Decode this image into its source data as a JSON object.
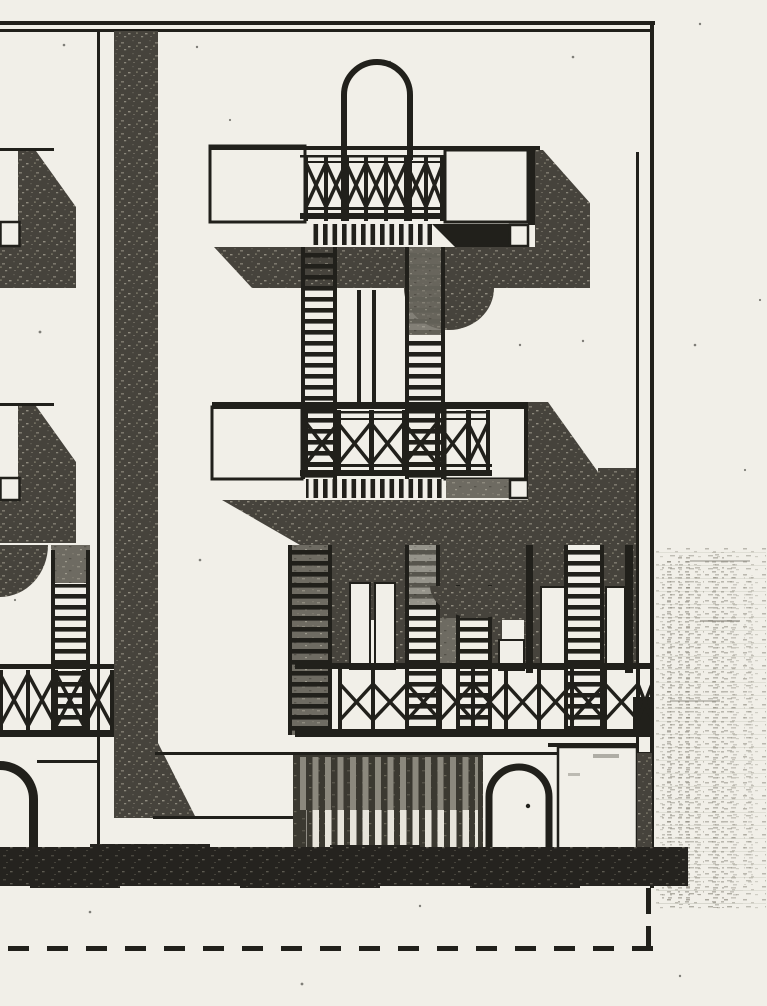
{
  "scan": {
    "kind": "photocopied architectural elevation drawing",
    "visible_text": "",
    "sheet_width_px": 767,
    "sheet_height_px": 1006
  },
  "colors": {
    "paper": "#f1efe8",
    "ink": "#21201b",
    "shadow": "#46433c",
    "shadowMid": "#6e6b62",
    "band": "#25231f",
    "gate": "#3b3931",
    "slatGray": "#8b887d",
    "slatWhite": "#e7e4db",
    "smudge": "#8e8b80"
  },
  "elements": {
    "frame": "drawing border frame",
    "left_building": "adjacent facade, partially visible at left edge",
    "party_wall": "dark party-wall pilaster with splayed base",
    "arch_top": "semicircular rooftop arch",
    "upper_balcony": "balcony with cross-braced railing and slat fascia",
    "ladder_columns": "paired louvre ladder columns",
    "middle_balcony": "balcony with cross-braced railing and slat fascia",
    "loggia": "loggia with louvred pillars and curved soffit shadow",
    "loggia_railing": "cross-braced loggia railing",
    "ground_floor": "slatted gate, arched entrance and wall panel",
    "ground_band": "dark ground strip",
    "site_line": "dashed grade line with corner return",
    "right_margin": "ink bleed-through smudge on paper margin"
  }
}
